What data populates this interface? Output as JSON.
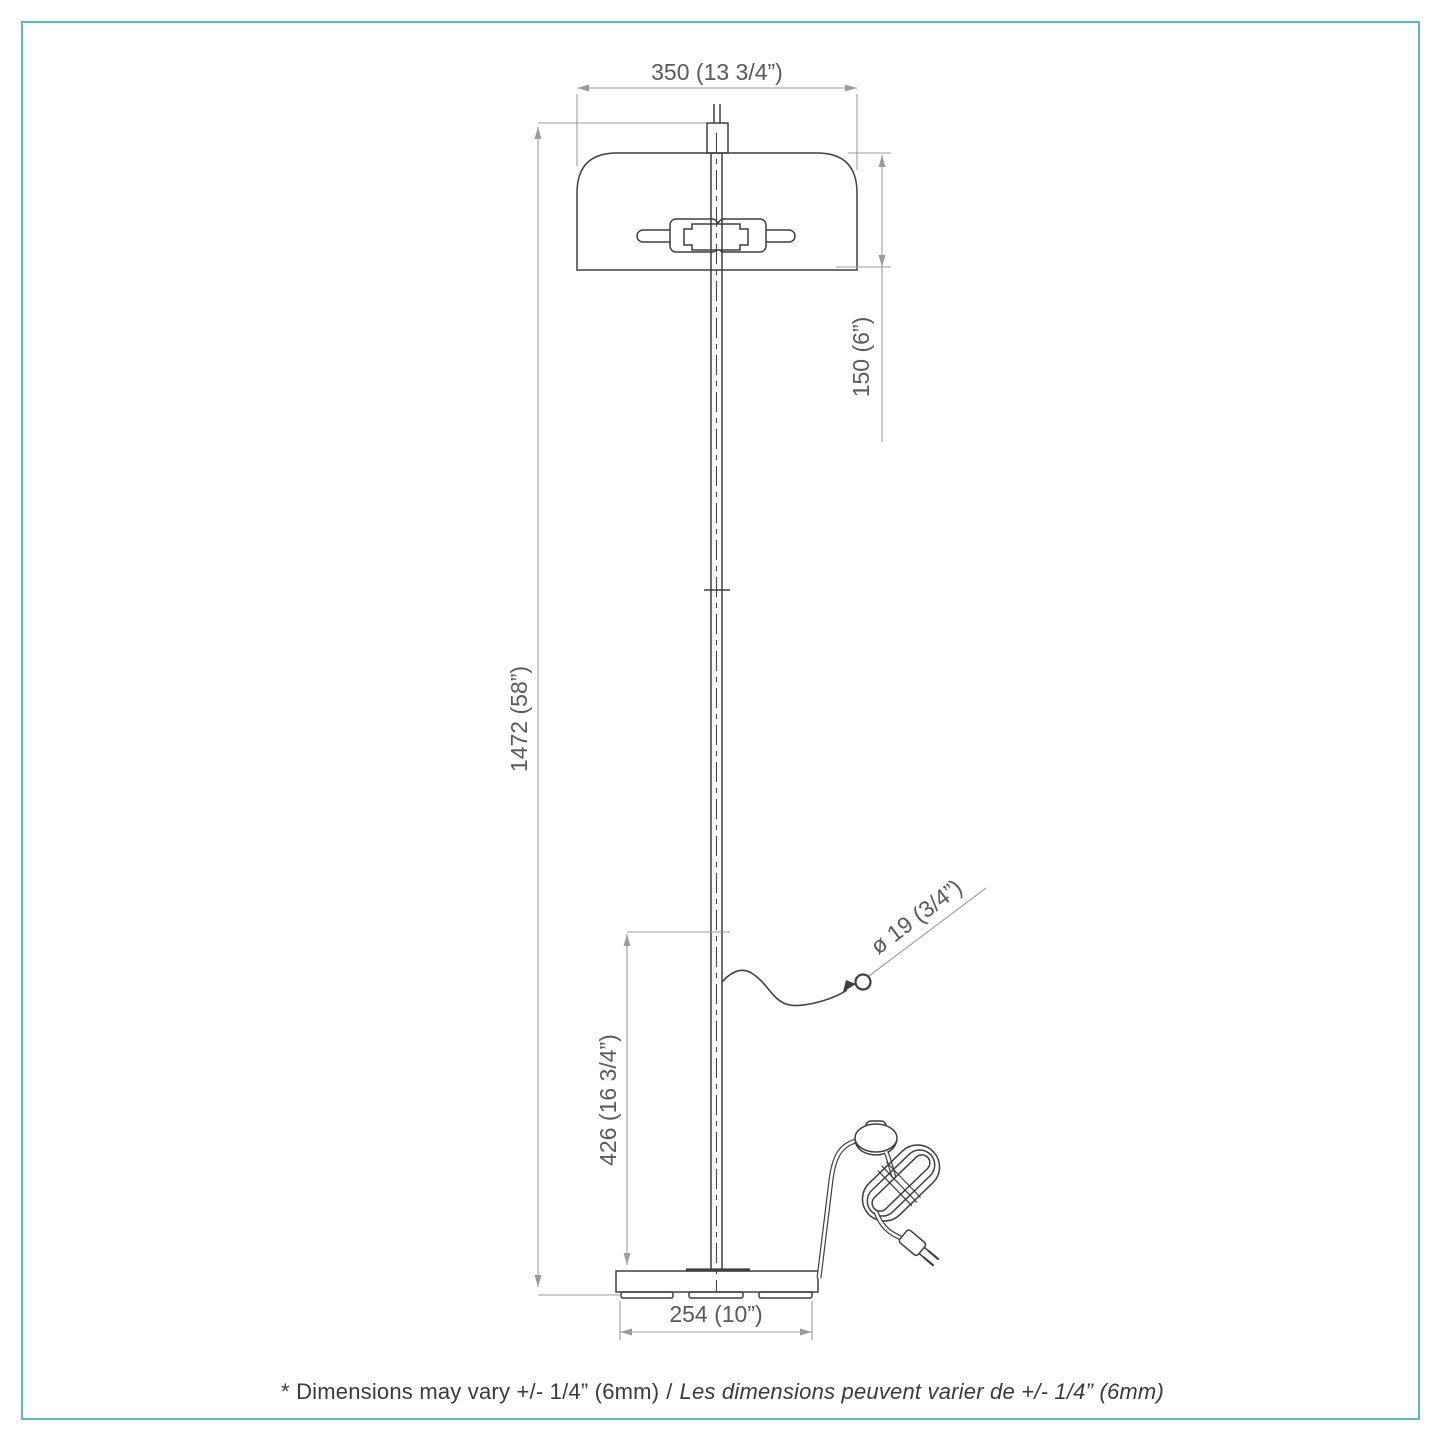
{
  "colors": {
    "frame_border": "#5cb9bd",
    "object_line": "#3f3f3f",
    "dimension_line": "#9b9b9b",
    "dimension_text": "#5a5a5a",
    "footer_text": "#3a3a3a"
  },
  "dimensions": {
    "shade_width": "350 (13 3/4”)",
    "shade_height": "150 (6”)",
    "total_height": "1472 (58”)",
    "cord_exit_height": "426 (16 3/4”)",
    "cord_diameter": "ø 19 (3/4”)",
    "base_width": "254 (10”)"
  },
  "footer": {
    "note_en": "* Dimensions may vary +/- 1/4” (6mm)",
    "separator": "/",
    "note_fr": "Les dimensions peuvent varier de +/- 1/4” (6mm)"
  }
}
